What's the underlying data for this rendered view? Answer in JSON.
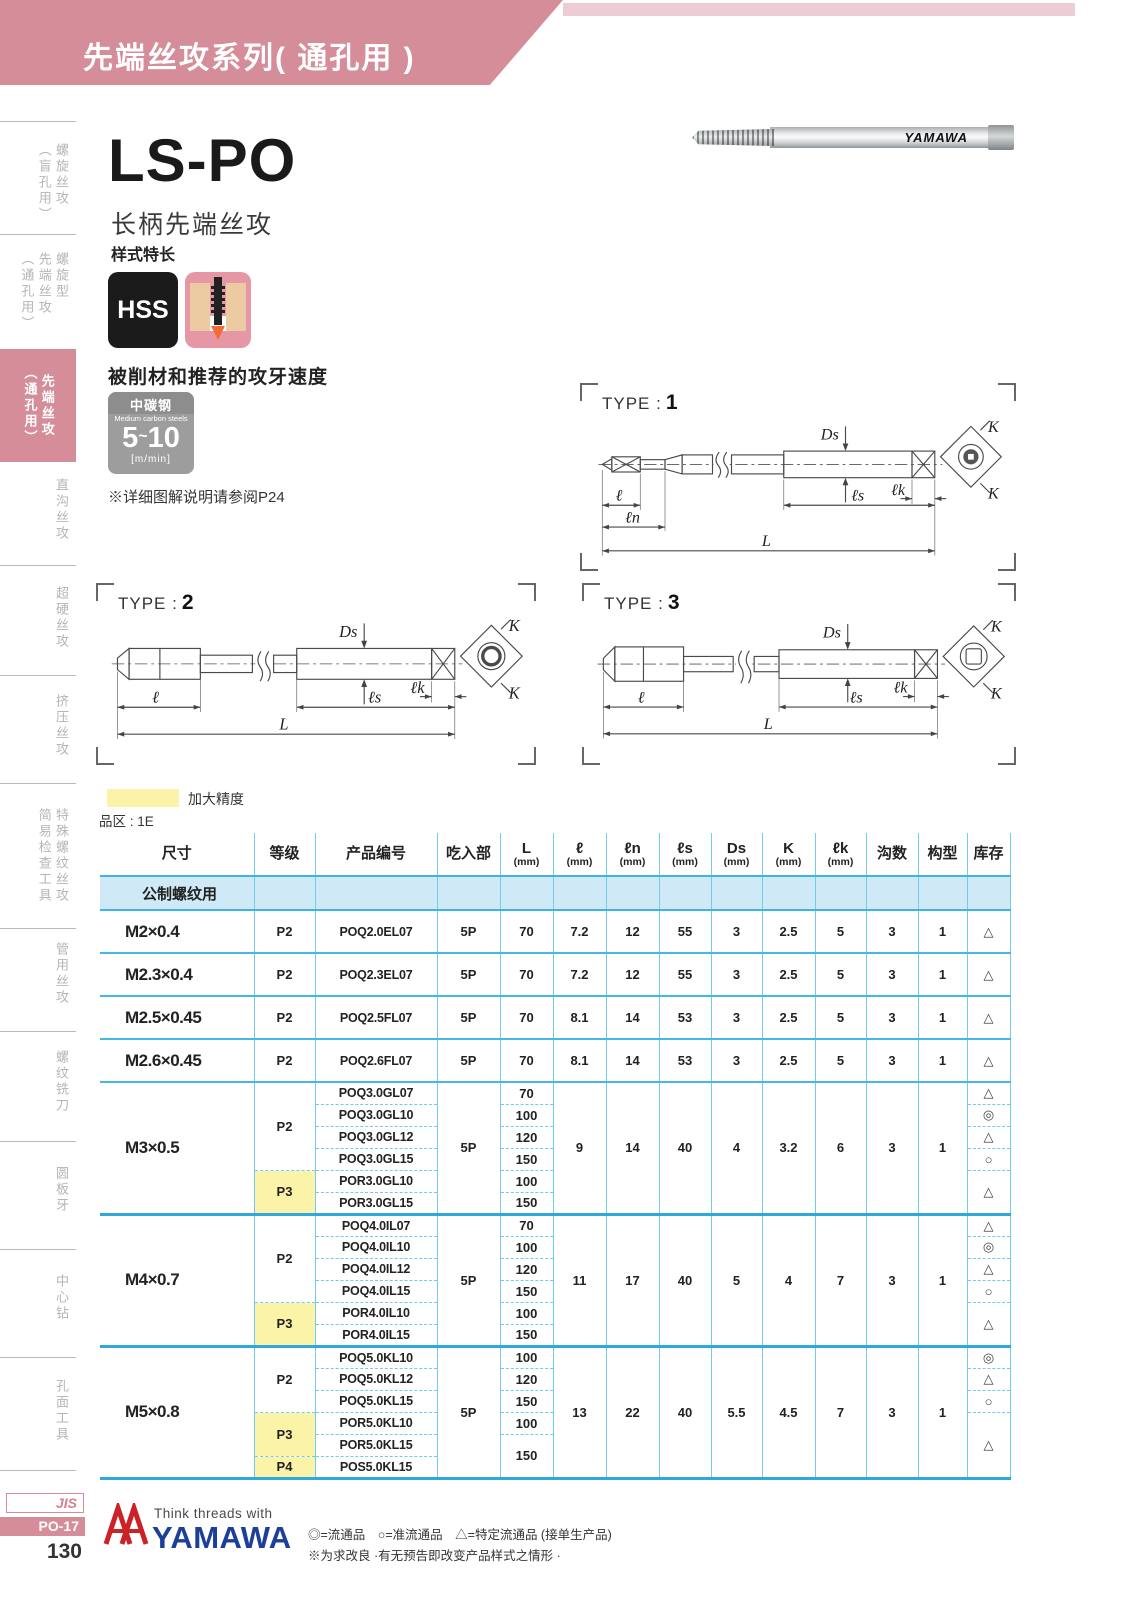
{
  "banner": {
    "title": "先端丝攻系列( 通孔用 )"
  },
  "sidebar": {
    "items": [
      {
        "cols": [
          "螺旋丝攻",
          "（盲孔用）"
        ],
        "active": false
      },
      {
        "cols": [
          "螺旋型",
          "先端丝攻",
          "（通孔用）"
        ],
        "active": false
      },
      {
        "cols": [
          "先端丝攻",
          "（通孔用）"
        ],
        "active": true
      },
      {
        "cols": [
          "直沟丝攻"
        ],
        "active": false
      },
      {
        "cols": [
          "超硬丝攻"
        ],
        "active": false
      },
      {
        "cols": [
          "挤压丝攻"
        ],
        "active": false
      },
      {
        "cols": [
          "特殊螺纹丝攻",
          "简易检查工具"
        ],
        "active": false
      },
      {
        "cols": [
          "管用丝攻"
        ],
        "active": false
      },
      {
        "cols": [
          "螺纹铣刀"
        ],
        "active": false
      },
      {
        "cols": [
          "圆板牙"
        ],
        "active": false
      },
      {
        "cols": [
          "中心钻"
        ],
        "active": false
      },
      {
        "cols": [
          "孔面工具"
        ],
        "active": false
      }
    ]
  },
  "product": {
    "model": "LS-PO",
    "name": "长柄先端丝攻",
    "style_label": "样式特长",
    "hss_badge": "HSS",
    "photo_brand": "YAMAWA",
    "speed_title": "被削材和推荐的攻牙速度",
    "speed_box": {
      "material_cn": "中碳钢",
      "material_en": "Medium carbon steels",
      "lo": "5",
      "tilde": "~",
      "hi": "10",
      "unit": "[m/min]"
    },
    "ref_note": "※详细图解说明请参阅P24"
  },
  "diagrams": {
    "type_prefix": "TYPE :",
    "types": [
      "1",
      "2",
      "3"
    ],
    "dims": {
      "L": "L",
      "l": "ℓ",
      "ln": "ℓn",
      "ls": "ℓs",
      "Ds": "Ds",
      "lk": "ℓk",
      "K": "K"
    }
  },
  "legend": {
    "swatch_label": "加大精度",
    "series_note": "品区 : 1E"
  },
  "table": {
    "headers": {
      "size": "尺寸",
      "grade": "等级",
      "code": "产品编号",
      "chamfer": "吃入部",
      "L": "L",
      "l": "ℓ",
      "ln": "ℓn",
      "ls": "ℓs",
      "Ds": "Ds",
      "K": "K",
      "lk": "ℓk",
      "mm": "(mm)",
      "flutes": "沟数",
      "form": "构型",
      "stock": "库存"
    },
    "section": "公制螺纹用",
    "singles": [
      {
        "size": "M2×0.4",
        "grade": "P2",
        "code": "POQ2.0EL07",
        "chamfer": "5P",
        "L": "70",
        "l": "7.2",
        "ln": "12",
        "ls": "55",
        "Ds": "3",
        "K": "2.5",
        "lk": "5",
        "flutes": "3",
        "form": "1",
        "stock": "△"
      },
      {
        "size": "M2.3×0.4",
        "grade": "P2",
        "code": "POQ2.3EL07",
        "chamfer": "5P",
        "L": "70",
        "l": "7.2",
        "ln": "12",
        "ls": "55",
        "Ds": "3",
        "K": "2.5",
        "lk": "5",
        "flutes": "3",
        "form": "1",
        "stock": "△"
      },
      {
        "size": "M2.5×0.45",
        "grade": "P2",
        "code": "POQ2.5FL07",
        "chamfer": "5P",
        "L": "70",
        "l": "8.1",
        "ln": "14",
        "ls": "53",
        "Ds": "3",
        "K": "2.5",
        "lk": "5",
        "flutes": "3",
        "form": "1",
        "stock": "△"
      },
      {
        "size": "M2.6×0.45",
        "grade": "P2",
        "code": "POQ2.6FL07",
        "chamfer": "5P",
        "L": "70",
        "l": "8.1",
        "ln": "14",
        "ls": "53",
        "Ds": "3",
        "K": "2.5",
        "lk": "5",
        "flutes": "3",
        "form": "1",
        "stock": "△"
      }
    ],
    "groups": [
      {
        "size": "M3×0.5",
        "grades": [
          "P2",
          "P3"
        ],
        "shared": {
          "chamfer": "5P",
          "l": "9",
          "ln": "14",
          "ls": "40",
          "Ds": "4",
          "K": "3.2",
          "lk": "6",
          "flutes": "3",
          "form": "1"
        },
        "rows": [
          {
            "code": "POQ3.0GL07",
            "L": "70",
            "stock": "△"
          },
          {
            "code": "POQ3.0GL10",
            "L": "100",
            "stock": "◎"
          },
          {
            "code": "POQ3.0GL12",
            "L": "120",
            "stock": "△"
          },
          {
            "code": "POQ3.0GL15",
            "L": "150",
            "stock": "○"
          },
          {
            "code": "POR3.0GL10",
            "L": "100",
            "stock": "△"
          },
          {
            "code": "POR3.0GL15",
            "L": "150"
          }
        ]
      },
      {
        "size": "M4×0.7",
        "grades": [
          "P2",
          "P3"
        ],
        "shared": {
          "chamfer": "5P",
          "l": "11",
          "ln": "17",
          "ls": "40",
          "Ds": "5",
          "K": "4",
          "lk": "7",
          "flutes": "3",
          "form": "1"
        },
        "rows": [
          {
            "code": "POQ4.0IL07",
            "L": "70",
            "stock": "△"
          },
          {
            "code": "POQ4.0IL10",
            "L": "100",
            "stock": "◎"
          },
          {
            "code": "POQ4.0IL12",
            "L": "120",
            "stock": "△"
          },
          {
            "code": "POQ4.0IL15",
            "L": "150",
            "stock": "○"
          },
          {
            "code": "POR4.0IL10",
            "L": "100",
            "stock": "△"
          },
          {
            "code": "POR4.0IL15",
            "L": "150"
          }
        ]
      },
      {
        "size": "M5×0.8",
        "grades": [
          "P2",
          "P3",
          "P4"
        ],
        "shared": {
          "chamfer": "5P",
          "l": "13",
          "ln": "22",
          "ls": "40",
          "Ds": "5.5",
          "K": "4.5",
          "lk": "7",
          "flutes": "3",
          "form": "1"
        },
        "rows": [
          {
            "code": "POQ5.0KL10",
            "L": "100",
            "stock": "◎"
          },
          {
            "code": "POQ5.0KL12",
            "L": "120",
            "stock": "△"
          },
          {
            "code": "POQ5.0KL15",
            "L": "150",
            "stock": "○"
          },
          {
            "code": "POR5.0KL10",
            "L": "100",
            "stock": "△"
          },
          {
            "code": "POR5.0KL15",
            "L": "150"
          },
          {
            "code": "POS5.0KL15"
          }
        ]
      }
    ]
  },
  "footer": {
    "jis": "JIS",
    "page_code": "PO-17",
    "page_number": "130",
    "tagline": "Think threads with",
    "brand": "YAMAWA",
    "stock_legend": "◎=流通品　○=准流通品　△=特定流通品 (接单生产品)",
    "disclaimer": "※为求改良 ·有无预告即改变产品样式之情形 ·"
  },
  "colors": {
    "banner_pink": "#d58d99",
    "banner_pink_light": "#eccdd3",
    "table_blue": "#2fa9dd",
    "table_blue_light": "#cfeaf6",
    "highlight_yellow": "#fbf3a8",
    "brand_blue": "#1c3f97",
    "brand_red": "#cc2127"
  }
}
